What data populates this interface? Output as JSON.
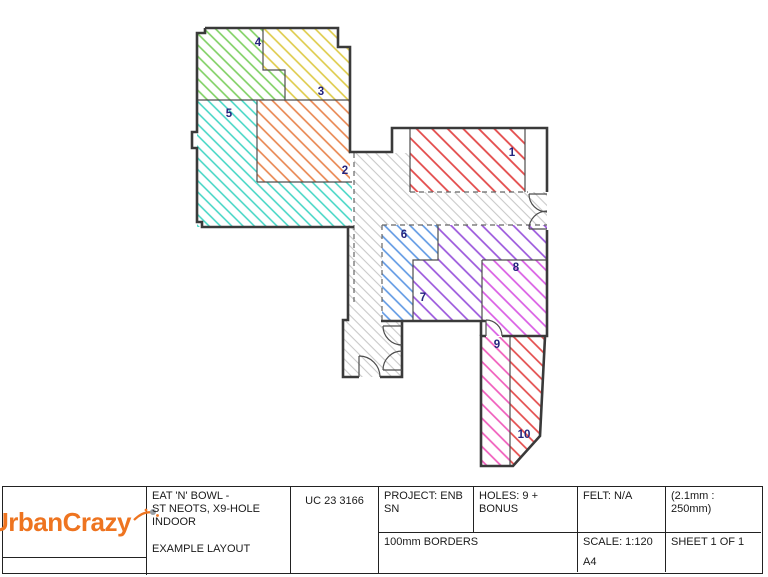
{
  "plan": {
    "wall_color": "#3a3a3a",
    "label_color": "#24247e",
    "corridor": {
      "color": "#c9c9c9"
    },
    "zones": [
      {
        "label": "1",
        "color": "#e34a4a"
      },
      {
        "label": "2",
        "color": "#e8824b"
      },
      {
        "label": "3",
        "color": "#ddca45"
      },
      {
        "label": "4",
        "color": "#7ccf5f"
      },
      {
        "label": "5",
        "color": "#3ed4c3"
      },
      {
        "label": "6",
        "color": "#5b96e3"
      },
      {
        "label": "7",
        "color": "#9a55dc"
      },
      {
        "label": "8",
        "color": "#d95ce4"
      },
      {
        "label": "9",
        "color": "#ef5bbb"
      },
      {
        "label": "10",
        "color": "#e34a4a"
      }
    ]
  },
  "title_block": {
    "logo_text": "UrbanCrazy",
    "logo_color": "#ee7420",
    "project_name_lines": [
      "EAT 'N' BOWL -",
      "ST NEOTS, X9-HOLE",
      "INDOOR"
    ],
    "layout_label": "EXAMPLE LAYOUT",
    "drawing_number": "UC 23 3166",
    "project": "PROJECT: ENB SN",
    "holes": "HOLES: 9 + BONUS",
    "felt": "FELT: N/A",
    "pen_scale": "(2.1mm : 250mm)",
    "borders": "100mm BORDERS",
    "scale": "SCALE: 1:120",
    "paper_size": "A4",
    "sheet": "SHEET 1 OF 1"
  }
}
